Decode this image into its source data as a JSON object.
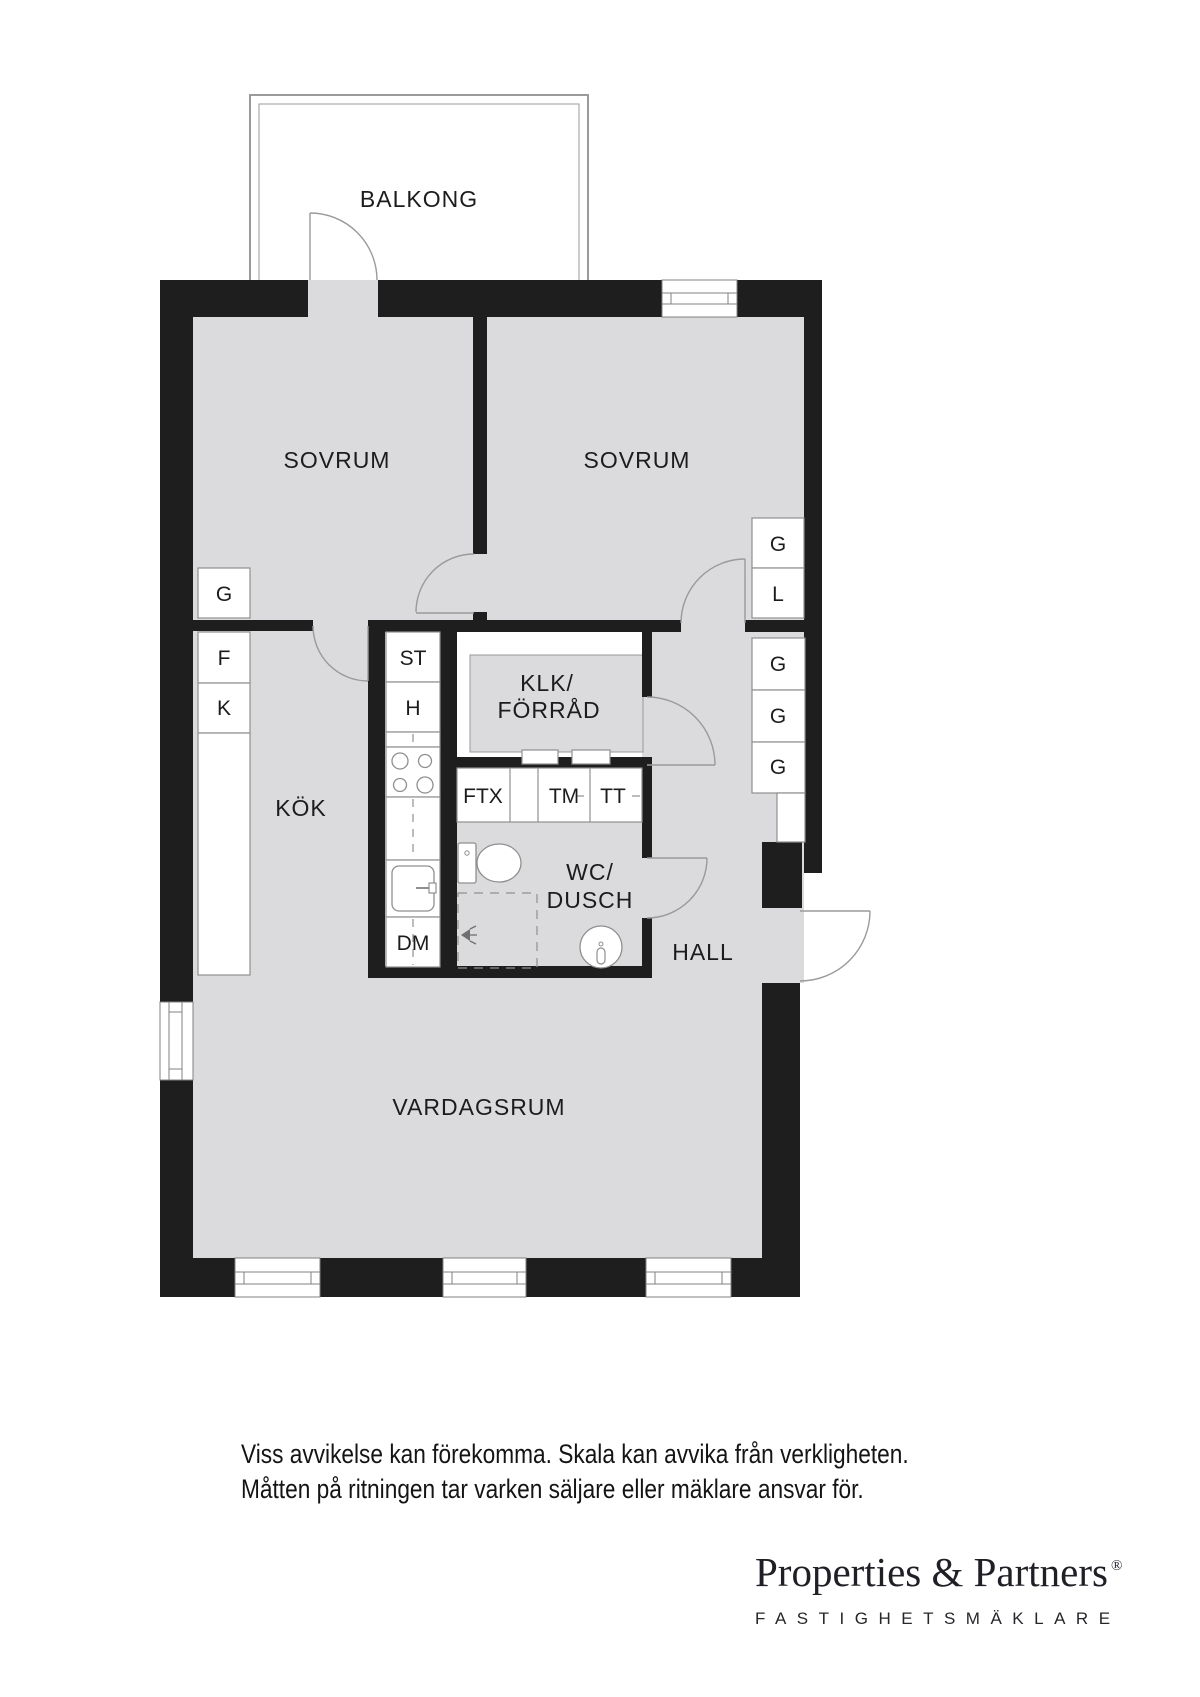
{
  "colors": {
    "wall": "#1e1e1e",
    "floor": "#dbdbdd",
    "thin_line": "#8f8f8f",
    "text": "#1c1c1c"
  },
  "rooms": {
    "balcony": "BALKONG",
    "bedroom_left": "SOVRUM",
    "bedroom_right": "SOVRUM",
    "kitchen": "KÖK",
    "living_room": "VARDAGSRUM",
    "hall": "HALL",
    "wc_line1": "WC/",
    "wc_line2": "DUSCH",
    "storage_line1": "KLK/",
    "storage_line2": "FÖRRÅD"
  },
  "labels": {
    "g": "G",
    "l": "L",
    "f": "F",
    "k": "K",
    "st": "ST",
    "h": "H",
    "dm": "DM",
    "ftx": "FTX",
    "tm": "TM",
    "tt": "TT"
  },
  "icons": [
    "toilet-icon",
    "shower-icon",
    "water-heater-icon",
    "stove-icon",
    "sink-icon"
  ],
  "disclaimer": {
    "line1": "Viss avvikelse kan förekomma. Skala kan avvika från verkligheten.",
    "line2": "Måtten på ritningen tar varken säljare eller mäklare ansvar för."
  },
  "brand": {
    "name": "Properties & Partners",
    "registered": "®",
    "tagline": "FASTIGHETSMÄKLARE"
  }
}
